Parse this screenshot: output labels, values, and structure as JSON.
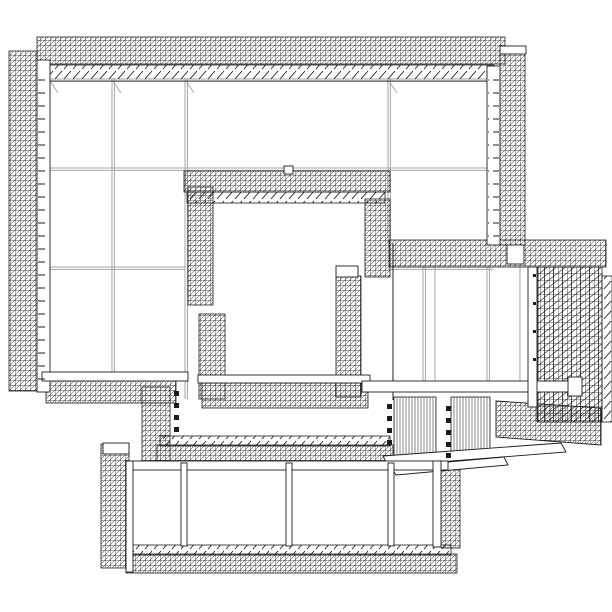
{
  "meta": {
    "description": "Black-and-white 3D wireframe architectural rendering of a building complex: a large panelized main block with cross-hatched scaffold bands on its edges, an inner courtyard framed by scaffold bands, a tall latticed structure on the right, louvered ramp blocks, and a lower rectangular wing at the bottom."
  },
  "canvas": {
    "width": 612,
    "height": 612,
    "background": "#ffffff"
  },
  "palette": {
    "line_black": "#1c1c1c",
    "line_gray": "#a6a6a6",
    "line_mid": "#555555",
    "fill_white": "#ffffff"
  },
  "scene": {
    "gridlines": [
      {
        "n": "main-floor-line-1",
        "x1": 48,
        "y1": 168,
        "x2": 493,
        "y2": 168,
        "c": "gray",
        "d": true
      },
      {
        "n": "main-floor-line-2-left",
        "x1": 48,
        "y1": 267,
        "x2": 185,
        "y2": 267,
        "c": "gray",
        "d": true
      },
      {
        "n": "main-floor-line-2-right",
        "x1": 388,
        "y1": 267,
        "x2": 493,
        "y2": 267,
        "c": "gray",
        "d": true
      },
      {
        "n": "main-top-edge-line",
        "x1": 42,
        "y1": 79,
        "x2": 494,
        "y2": 79,
        "c": "gray",
        "d": true
      },
      {
        "n": "main-column-line-1",
        "x1": 112,
        "y1": 78,
        "x2": 112,
        "y2": 377,
        "c": "gray",
        "d": true
      },
      {
        "n": "main-column-line-2",
        "x1": 185,
        "y1": 78,
        "x2": 185,
        "y2": 399,
        "c": "gray",
        "d": true
      },
      {
        "n": "main-column-line-3",
        "x1": 388,
        "y1": 78,
        "x2": 388,
        "y2": 243,
        "c": "gray",
        "d": true
      },
      {
        "n": "main-left-inner-edge",
        "x1": 48,
        "y1": 78,
        "x2": 48,
        "y2": 377,
        "c": "gray",
        "d": false
      },
      {
        "n": "right-structure-left-edge",
        "x1": 393,
        "y1": 243,
        "x2": 393,
        "y2": 400,
        "c": "black",
        "d": false
      },
      {
        "n": "right-wall-line-1",
        "x1": 423,
        "y1": 267,
        "x2": 423,
        "y2": 384,
        "c": "gray",
        "d": true
      },
      {
        "n": "right-wall-line-2",
        "x1": 435,
        "y1": 267,
        "x2": 435,
        "y2": 384,
        "c": "gray",
        "d": false
      },
      {
        "n": "right-wall-line-3",
        "x1": 487,
        "y1": 267,
        "x2": 487,
        "y2": 384,
        "c": "gray",
        "d": true
      },
      {
        "n": "right-wall-line-4",
        "x1": 520,
        "y1": 267,
        "x2": 520,
        "y2": 384,
        "c": "gray",
        "d": false
      },
      {
        "n": "right-lattice-front-edge",
        "x1": 537,
        "y1": 267,
        "x2": 537,
        "y2": 422,
        "c": "black",
        "d": false
      },
      {
        "n": "corner-tick-1",
        "x1": 50,
        "y1": 81,
        "x2": 58,
        "y2": 93,
        "c": "gray",
        "d": false
      },
      {
        "n": "corner-tick-2",
        "x1": 113,
        "y1": 81,
        "x2": 121,
        "y2": 93,
        "c": "gray",
        "d": false
      },
      {
        "n": "corner-tick-3",
        "x1": 186,
        "y1": 81,
        "x2": 194,
        "y2": 93,
        "c": "gray",
        "d": false
      },
      {
        "n": "corner-tick-4",
        "x1": 389,
        "y1": 81,
        "x2": 397,
        "y2": 93,
        "c": "gray",
        "d": false
      }
    ],
    "bands": [
      {
        "n": "top-scaffold-band",
        "x": 37,
        "y": 37,
        "w": 468,
        "h": 27,
        "f": "dense"
      },
      {
        "n": "top-eave-tick-band",
        "x": 42,
        "y": 65,
        "w": 452,
        "h": 16,
        "f": "sparse"
      },
      {
        "n": "left-scaffold-band",
        "x": 9,
        "y": 51,
        "w": 28,
        "h": 340,
        "f": "dense"
      },
      {
        "n": "right-edge-scaffold-band",
        "x": 500,
        "y": 52,
        "w": 25,
        "h": 193,
        "f": "dense"
      },
      {
        "n": "leftwing-bottom-band",
        "x": 46,
        "y": 381,
        "w": 130,
        "h": 22,
        "f": "dense"
      },
      {
        "n": "courtyard-top-band",
        "x": 184,
        "y": 171,
        "w": 206,
        "h": 21,
        "f": "dense"
      },
      {
        "n": "courtyard-top-inner-ticks",
        "x": 187,
        "y": 192,
        "w": 198,
        "h": 11,
        "f": "sparse"
      },
      {
        "n": "courtyard-left-upper-band",
        "x": 188,
        "y": 187,
        "w": 25,
        "h": 118,
        "f": "dense"
      },
      {
        "n": "courtyard-left-lower-band",
        "x": 199,
        "y": 314,
        "w": 26,
        "h": 85,
        "f": "dense"
      },
      {
        "n": "courtyard-right-upper-band",
        "x": 365,
        "y": 199,
        "w": 25,
        "h": 78,
        "f": "dense"
      },
      {
        "n": "courtyard-right-lower-band",
        "x": 336,
        "y": 276,
        "w": 25,
        "h": 121,
        "f": "dense"
      },
      {
        "n": "courtyard-bottom-band",
        "x": 202,
        "y": 383,
        "w": 166,
        "h": 25,
        "f": "dense"
      },
      {
        "n": "right-structure-top-band",
        "x": 389,
        "y": 240,
        "w": 217,
        "h": 27,
        "f": "dense"
      },
      {
        "n": "right-structure-tall-lattice",
        "x": 538,
        "y": 267,
        "w": 64,
        "h": 155,
        "f": "dense2"
      },
      {
        "n": "right-structure-edge-braces",
        "x": 602,
        "y": 276,
        "w": 10,
        "h": 146,
        "f": "sparse"
      },
      {
        "n": "connector-vertical-band",
        "x": 142,
        "y": 387,
        "w": 28,
        "h": 78,
        "f": "dense"
      },
      {
        "n": "bottombldg-top-tick-band",
        "x": 160,
        "y": 436,
        "w": 230,
        "h": 10,
        "f": "sparse"
      },
      {
        "n": "bottombldg-top-band",
        "x": 157,
        "y": 445,
        "w": 236,
        "h": 18,
        "f": "dense"
      },
      {
        "n": "bottombldg-left-tower",
        "x": 101,
        "y": 444,
        "w": 28,
        "h": 124,
        "f": "dense"
      },
      {
        "n": "bottombldg-bottom-tick-band",
        "x": 129,
        "y": 545,
        "w": 322,
        "h": 10,
        "f": "sparse"
      },
      {
        "n": "bottombldg-bottom-band",
        "x": 126,
        "y": 554,
        "w": 331,
        "h": 19,
        "f": "dense"
      },
      {
        "n": "bottombldg-right-band",
        "x": 441,
        "y": 464,
        "w": 19,
        "h": 84,
        "f": "dense"
      },
      {
        "n": "louver-block-a",
        "x": 394,
        "y": 397,
        "w": 42,
        "h": 61,
        "f": "louver"
      },
      {
        "n": "louver-block-b",
        "x": 451,
        "y": 397,
        "w": 39,
        "h": 63,
        "f": "louver"
      }
    ],
    "polys": [
      {
        "n": "right-structure-bottom-band",
        "pts": "496,401 601,408 601,445 496,437",
        "f": "dense"
      },
      {
        "n": "ramp-beam-upper",
        "pts": "383,456 561,443 566,452 388,466",
        "f": "white"
      },
      {
        "n": "ramp-beam-lower",
        "pts": "391,467 504,457 508,465 396,475",
        "f": "white"
      }
    ],
    "beams": [
      {
        "n": "left-wall-face",
        "x": 37,
        "y": 60,
        "w": 13,
        "h": 332
      },
      {
        "n": "right-wall-face",
        "x": 487,
        "y": 66,
        "w": 13,
        "h": 179
      },
      {
        "n": "leftwing-bottom-beam",
        "x": 42,
        "y": 372,
        "w": 146,
        "h": 9
      },
      {
        "n": "courtyard-bottom-beam",
        "x": 198,
        "y": 375,
        "w": 172,
        "h": 8
      },
      {
        "n": "bottombldg-top-beam",
        "x": 126,
        "y": 461,
        "w": 322,
        "h": 9
      },
      {
        "n": "main-girder",
        "x": 362,
        "y": 381,
        "w": 216,
        "h": 11
      },
      {
        "n": "girder-end-cap",
        "x": 568,
        "y": 377,
        "w": 14,
        "h": 19
      },
      {
        "n": "bottombldg-column-1",
        "x": 181,
        "y": 463,
        "w": 6,
        "h": 83
      },
      {
        "n": "bottombldg-column-2",
        "x": 286,
        "y": 463,
        "w": 6,
        "h": 83
      },
      {
        "n": "bottombldg-column-3",
        "x": 388,
        "y": 463,
        "w": 6,
        "h": 83
      },
      {
        "n": "bottombldg-left-edge",
        "x": 126,
        "y": 461,
        "w": 7,
        "h": 111
      },
      {
        "n": "bottombldg-right-edge",
        "x": 433,
        "y": 461,
        "w": 8,
        "h": 86
      },
      {
        "n": "left-tower-cap",
        "x": 103,
        "y": 443,
        "w": 26,
        "h": 11
      },
      {
        "n": "courtyard-band-cap",
        "x": 336,
        "y": 266,
        "w": 22,
        "h": 11
      },
      {
        "n": "right-wall-beam",
        "x": 528,
        "y": 267,
        "w": 9,
        "h": 140
      },
      {
        "n": "top-band-gap-beam",
        "x": 507,
        "y": 245,
        "w": 17,
        "h": 19
      },
      {
        "n": "courtyard-top-square",
        "x": 284,
        "y": 166,
        "w": 9,
        "h": 8
      },
      {
        "n": "right-band-top-cap",
        "x": 500,
        "y": 46,
        "w": 26,
        "h": 8
      }
    ],
    "wallticks": [
      {
        "n": "left-wall-floor-ticks",
        "x": 38,
        "y": 72,
        "w": 11,
        "h": 310
      },
      {
        "n": "right-wall-floor-ticks",
        "x": 488,
        "y": 74,
        "w": 11,
        "h": 165
      }
    ],
    "dots": [
      {
        "n": "dot-col-left",
        "x": 174,
        "y": 391,
        "s": 5
      },
      {
        "n": "dot-col-left",
        "x": 174,
        "y": 403,
        "s": 5
      },
      {
        "n": "dot-col-left",
        "x": 174,
        "y": 415,
        "s": 5
      },
      {
        "n": "dot-col-left",
        "x": 174,
        "y": 427,
        "s": 5
      },
      {
        "n": "dot-col-mid",
        "x": 387,
        "y": 404,
        "s": 5
      },
      {
        "n": "dot-col-mid",
        "x": 387,
        "y": 416,
        "s": 5
      },
      {
        "n": "dot-col-mid",
        "x": 387,
        "y": 428,
        "s": 5
      },
      {
        "n": "dot-col-mid",
        "x": 387,
        "y": 440,
        "s": 5
      },
      {
        "n": "dot-col-right",
        "x": 446,
        "y": 406,
        "s": 5
      },
      {
        "n": "dot-col-right",
        "x": 446,
        "y": 418,
        "s": 5
      },
      {
        "n": "dot-col-right",
        "x": 446,
        "y": 430,
        "s": 5
      },
      {
        "n": "dot-col-right",
        "x": 446,
        "y": 442,
        "s": 5
      },
      {
        "n": "dot-col-right",
        "x": 446,
        "y": 453,
        "s": 5
      },
      {
        "n": "beam-rivet",
        "x": 533,
        "y": 274,
        "s": 3
      },
      {
        "n": "beam-rivet",
        "x": 533,
        "y": 302,
        "s": 3
      },
      {
        "n": "beam-rivet",
        "x": 533,
        "y": 330,
        "s": 3
      },
      {
        "n": "beam-rivet",
        "x": 533,
        "y": 358,
        "s": 3
      }
    ]
  }
}
